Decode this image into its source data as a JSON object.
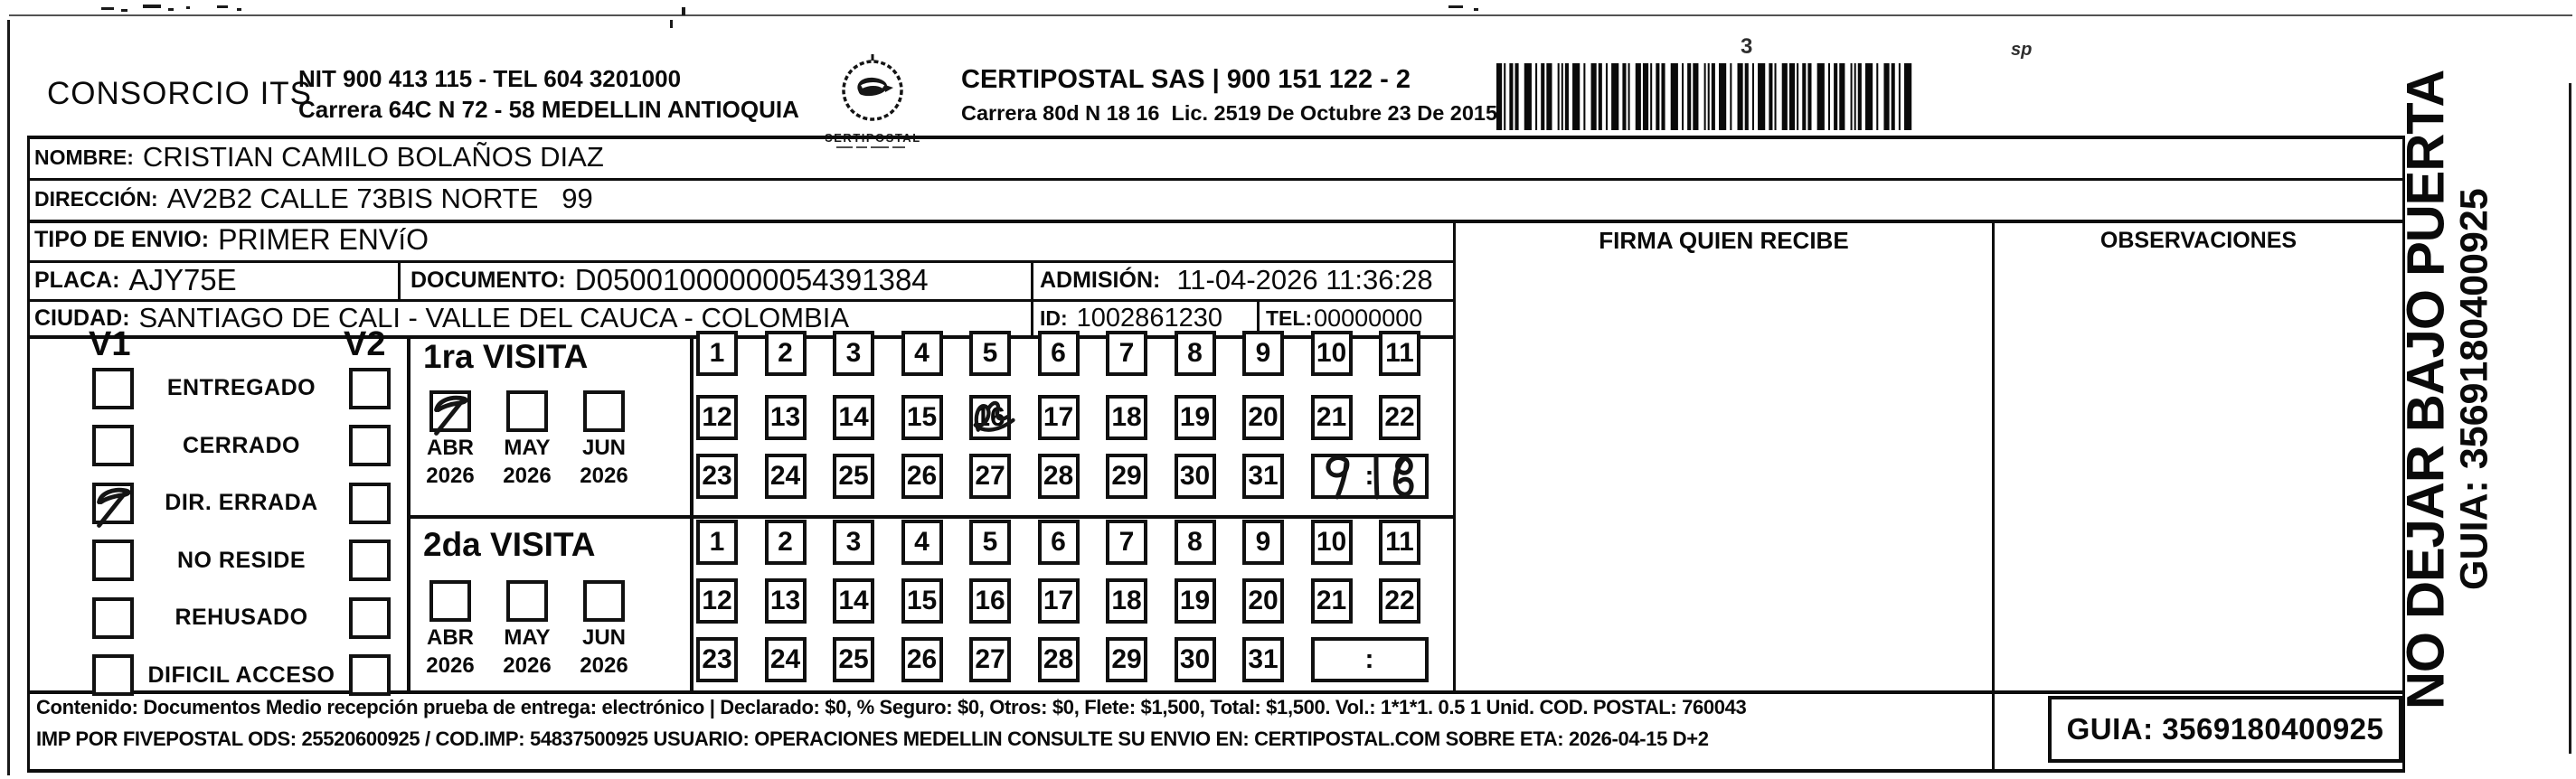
{
  "header": {
    "company": "CONSORCIO ITS",
    "nit_line": "NIT 900 413 115 - TEL 604 3201000",
    "addr_line": "Carrera 64C N 72 - 58 MEDELLIN ANTIOQUIA",
    "logo_text": "CERTIPOSTAL",
    "provider_line1": "CERTIPOSTAL SAS | 900 151 122 - 2",
    "provider_line2": "Carrera 80d N 18 16  Lic. 2519 De Octubre 23 De 2015"
  },
  "fields": {
    "nombre_label": "NOMBRE:",
    "nombre": "CRISTIAN CAMILO BOLAÑOS DIAZ",
    "direccion_label": "DIRECCIÓN:",
    "direccion": "AV2B2 CALLE 73BIS NORTE   99",
    "tipo_label": "TIPO DE ENVIO:",
    "tipo": "PRIMER ENVíO",
    "placa_label": "PLACA:",
    "placa": "AJY75E",
    "documento_label": "DOCUMENTO:",
    "documento": "D05001000000054391384",
    "admision_label": "ADMISIÓN:",
    "admision": "11-04-2026 11:36:28",
    "ciudad_label": "CIUDAD:",
    "ciudad": "SANTIAGO DE CALI - VALLE DEL CAUCA - COLOMBIA",
    "id_label": "ID:",
    "id_value": "1002861230",
    "tel_label": "TEL:",
    "tel": "00000000"
  },
  "columns": {
    "firma": "FIRMA QUIEN RECIBE",
    "observaciones": "OBSERVACIONES"
  },
  "status_panel": {
    "v1": "V1",
    "v2": "V2",
    "options": [
      {
        "label": "ENTREGADO",
        "v1": false,
        "v2": false
      },
      {
        "label": "CERRADO",
        "v1": false,
        "v2": false
      },
      {
        "label": "DIR. ERRADA",
        "v1": true,
        "v2": false
      },
      {
        "label": "NO RESIDE",
        "v1": false,
        "v2": false
      },
      {
        "label": "REHUSADO",
        "v1": false,
        "v2": false
      },
      {
        "label": "DIFICIL ACCESO",
        "v1": false,
        "v2": false
      }
    ]
  },
  "visits": [
    {
      "title": "1ra VISITA",
      "months": [
        {
          "month": "ABR",
          "year": "2026",
          "checked": true
        },
        {
          "month": "MAY",
          "year": "2026",
          "checked": false
        },
        {
          "month": "JUN",
          "year": "2026",
          "checked": false
        }
      ],
      "day_rows": [
        [
          "1",
          "2",
          "3",
          "4",
          "5",
          "6",
          "7",
          "8",
          "9",
          "10",
          "11"
        ],
        [
          "12",
          "13",
          "14",
          "15",
          "16",
          "17",
          "18",
          "19",
          "20",
          "21",
          "22"
        ],
        [
          "23",
          "24",
          "25",
          "26",
          "27",
          "28",
          "29",
          "30",
          "31"
        ]
      ],
      "scribbled_day": "16",
      "time_separator": ":",
      "handwritten_time": "9:18"
    },
    {
      "title": "2da VISITA",
      "months": [
        {
          "month": "ABR",
          "year": "2026",
          "checked": false
        },
        {
          "month": "MAY",
          "year": "2026",
          "checked": false
        },
        {
          "month": "JUN",
          "year": "2026",
          "checked": false
        }
      ],
      "day_rows": [
        [
          "1",
          "2",
          "3",
          "4",
          "5",
          "6",
          "7",
          "8",
          "9",
          "10",
          "11"
        ],
        [
          "12",
          "13",
          "14",
          "15",
          "16",
          "17",
          "18",
          "19",
          "20",
          "21",
          "22"
        ],
        [
          "23",
          "24",
          "25",
          "26",
          "27",
          "28",
          "29",
          "30",
          "31"
        ]
      ],
      "scribbled_day": "",
      "time_separator": ":",
      "handwritten_time": ""
    }
  ],
  "footer": {
    "line1": "Contenido: Documentos Medio recepción prueba de entrega: electrónico | Declarado: $0, % Seguro: $0, Otros: $0, Flete: $1,500, Total: $1,500. Vol.: 1*1*1. 0.5  1 Unid. COD. POSTAL: 760043",
    "line2": "IMP POR FIVEPOSTAL ODS: 25520600925 / COD.IMP: 54837500925 USUARIO: OPERACIONES MEDELLIN CONSULTE SU ENVIO EN: CERTIPOSTAL.COM SOBRE ETA: 2026-04-15 D+2",
    "guia": "GUIA: 3569180400925"
  },
  "side": {
    "warning": "NO DEJAR BAJO PUERTA",
    "guia": "GUIA: 3569180400925"
  },
  "artifacts": {
    "mark1": "3",
    "mark2": "sp"
  },
  "colors": {
    "ink": "#0a0a0a",
    "paper": "#ffffff"
  }
}
